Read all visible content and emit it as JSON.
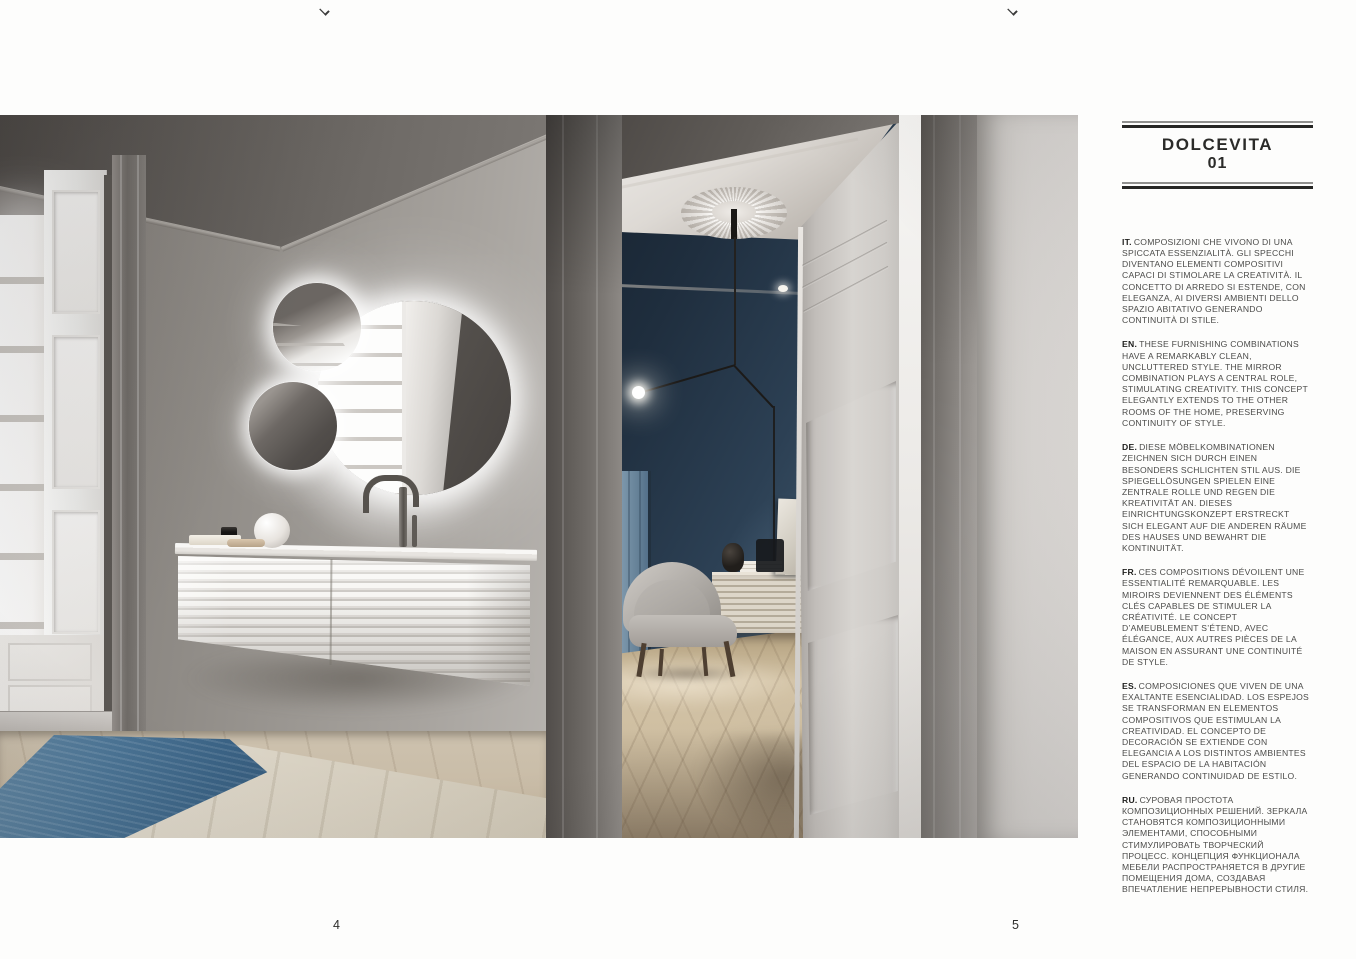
{
  "page": {
    "left_page_number": "4",
    "right_page_number": "5",
    "top_cropped_glyphs": 2
  },
  "article": {
    "title": "DOLCEVITA",
    "number": "01",
    "paragraphs": [
      {
        "lang": "IT.",
        "text": "COMPOSIZIONI CHE VIVONO DI UNA SPICCATA ESSENZIALITÀ. GLI SPECCHI DIVENTANO ELEMENTI COMPOSITIVI CAPACI DI STIMOLARE LA CREATIVITÀ. IL CONCETTO DI ARREDO SI ESTENDE, CON ELEGANZA, AI DIVERSI AMBIENTI DELLO SPAZIO ABITATIVO GENERANDO CONTINUITÀ DI STILE."
      },
      {
        "lang": "EN.",
        "text": "THESE FURNISHING COMBINATIONS HAVE A REMARKABLY CLEAN, UNCLUTTERED STYLE. THE MIRROR COMBINATION PLAYS A CENTRAL ROLE, STIMULATING CREATIVITY. THIS CONCEPT ELEGANTLY EXTENDS TO THE OTHER ROOMS OF THE HOME, PRESERVING CONTINUITY OF STYLE."
      },
      {
        "lang": "DE.",
        "text": "DIESE MÖBELKOMBINATIONEN ZEICHNEN SICH DURCH EINEN BESONDERS SCHLICHTEN STIL AUS. DIE SPIEGELLÖSUNGEN SPIELEN EINE ZENTRALE ROLLE UND REGEN DIE KREATIVITÄT AN. DIESES EINRICHTUNGSKONZEPT ERSTRECKT SICH ELEGANT AUF DIE ANDEREN RÄUME DES HAUSES UND BEWAHRT DIE KONTINUITÄT."
      },
      {
        "lang": "FR.",
        "text": "CES COMPOSITIONS DÉVOILENT UNE ESSENTIALITÉ REMARQUABLE. LES MIROIRS DEVIENNENT DES ÉLÉMENTS CLÉS CAPABLES DE STIMULER LA CRÉATIVITÉ. LE CONCEPT D’AMEUBLEMENT S’ÉTEND, AVEC ÉLÉGANCE, AUX AUTRES PIÈCES DE LA MAISON EN ASSURANT UNE CONTINUITÉ DE STYLE."
      },
      {
        "lang": "ES.",
        "text": "COMPOSICIONES QUE VIVEN DE UNA EXALTANTE ESENCIALIDAD. LOS ESPEJOS SE TRANSFORMAN EN ELEMENTOS COMPOSITIVOS QUE ESTIMULAN LA CREATIVIDAD. EL CONCEPTO DE DECORACIÓN SE EXTIENDE CON ELEGANCIA A LOS DISTINTOS AMBIENTES DEL ESPACIO DE LA HABITACIÓN GENERANDO CONTINUIDAD DE ESTILO."
      },
      {
        "lang": "RU.",
        "text": "СУРОВАЯ ПРОСТОТА КОМПОЗИЦИОННЫХ РЕШЕНИЙ. ЗЕРКАЛА СТАНОВЯТСЯ КОМПОЗИЦИОННЫМИ ЭЛЕМЕНТАМИ, СПОСОБНЫМИ СТИМУЛИРОВАТЬ ТВОРЧЕСКИЙ ПРОЦЕСС. КОНЦЕПЦИЯ ФУНКЦИОНАЛА МЕБЕЛИ РАСПРОСТРАНЯЕТСЯ В ДРУГИЕ ПОМЕЩЕНИЯ ДОМА, СОЗДАВАЯ ВПЕЧАТЛЕНИЕ НЕПРЕРЫВНОСТИ СТИЛЯ."
      }
    ]
  },
  "photo": {
    "subject": "Bathroom interior with three round backlit mirrors, wall-hung fluted vanity and open door to a dark blue room",
    "palette": {
      "wall_gray": "#a7a39e",
      "ceiling_gray": "#5f5b57",
      "inner_wall_blue": "#2c4054",
      "parquet_beige": "#cfbfa2",
      "rug_blue": "#4a7394",
      "rug_beige": "#d8d1c2",
      "vanity_white": "#f2f0ed"
    }
  }
}
